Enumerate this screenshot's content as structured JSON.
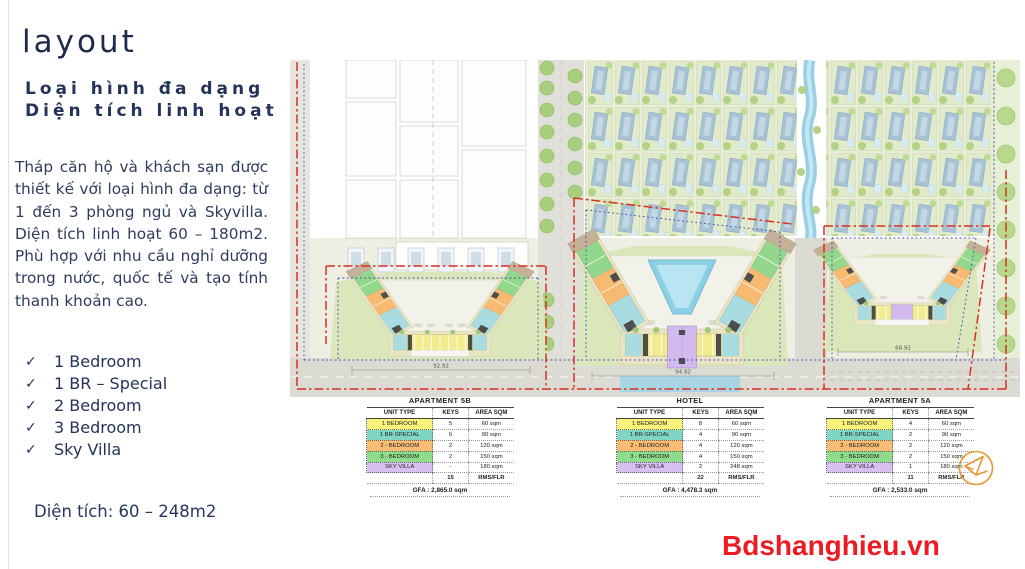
{
  "panel": {
    "title": "layout",
    "subtitle_line1": "Loại hình đa dạng",
    "subtitle_line2": "Diện tích linh hoạt",
    "body": "Tháp căn hộ và khách sạn được thiết kế với loại hình đa dạng: từ 1 đến 3 phòng ngủ và Skyvilla. Diện tích linh hoạt 60 – 180m2. Phù hợp với nhu cầu nghỉ dưỡng trong nước, quốc tế và tạo tính thanh khoản cao.",
    "check_glyph": "✓",
    "checklist": [
      "1 Bedroom",
      "1 BR – Special",
      "2 Bedroom",
      "3 Bedroom",
      "Sky Villa"
    ],
    "area_note": "Diện tích: 60 – 248m2"
  },
  "table_headers": [
    "UNIT TYPE",
    "KEYS",
    "AREA SQM"
  ],
  "tables": [
    {
      "title": "APARTMENT 5B",
      "rows": [
        [
          "1 BEDROOM",
          "5",
          "60 sqm"
        ],
        [
          "1 BR-SPECIAL",
          "6",
          "90 sqm"
        ],
        [
          "2 - BEDROOM",
          "2",
          "120 sqm"
        ],
        [
          "3 - BEDROOM",
          "2",
          "150 sqm"
        ],
        [
          "SKY VILLA",
          "-",
          "180 sqm"
        ]
      ],
      "total_keys": "15",
      "total_label": "RMS/FLR",
      "gfa": "GFA : 2,865.0 sqm"
    },
    {
      "title": "HOTEL",
      "rows": [
        [
          "1 BEDROOM",
          "8",
          "60 sqm"
        ],
        [
          "1 BR-SPECIAL",
          "4",
          "90 sqm"
        ],
        [
          "2 - BEDROOM",
          "4",
          "120 sqm"
        ],
        [
          "3 - BEDROOM",
          "4",
          "150 sqm"
        ],
        [
          "SKY VILLA",
          "2",
          "248 sqm"
        ]
      ],
      "total_keys": "22",
      "total_label": "RMS/FLR",
      "gfa": "GFA : 4,478.3 sqm"
    },
    {
      "title": "APARTMENT 5A",
      "rows": [
        [
          "1 BEDROOM",
          "4",
          "60 sqm"
        ],
        [
          "1 BR-SPECIAL",
          "2",
          "90 sqm"
        ],
        [
          "2 - BEDROOM",
          "2",
          "120 sqm"
        ],
        [
          "3 - BEDROOM",
          "2",
          "150 sqm"
        ],
        [
          "SKY VILLA",
          "1",
          "180 sqm"
        ]
      ],
      "total_keys": "11",
      "total_label": "RMS/FLR",
      "gfa": "GFA : 2,533.0 sqm"
    }
  ],
  "site_plan": {
    "dim_apartment_5b": "92.92",
    "dim_hotel": "94.92",
    "dim_apartment_5a": "68.92"
  },
  "watermark": {
    "text": "Bdshanghieu.vn",
    "color": "#ed1c24"
  },
  "colors": {
    "navy_text": "#24335a",
    "boundary_red": "#d92f22",
    "boundary_blue": "#4a43b5",
    "unit_yellow": "#f9f37c",
    "unit_teal": "#7fd6c4",
    "unit_orange": "#f8bd72",
    "unit_green": "#8fdc8a",
    "unit_purple": "#d9c0f2",
    "logo_orange": "#e8952f"
  }
}
